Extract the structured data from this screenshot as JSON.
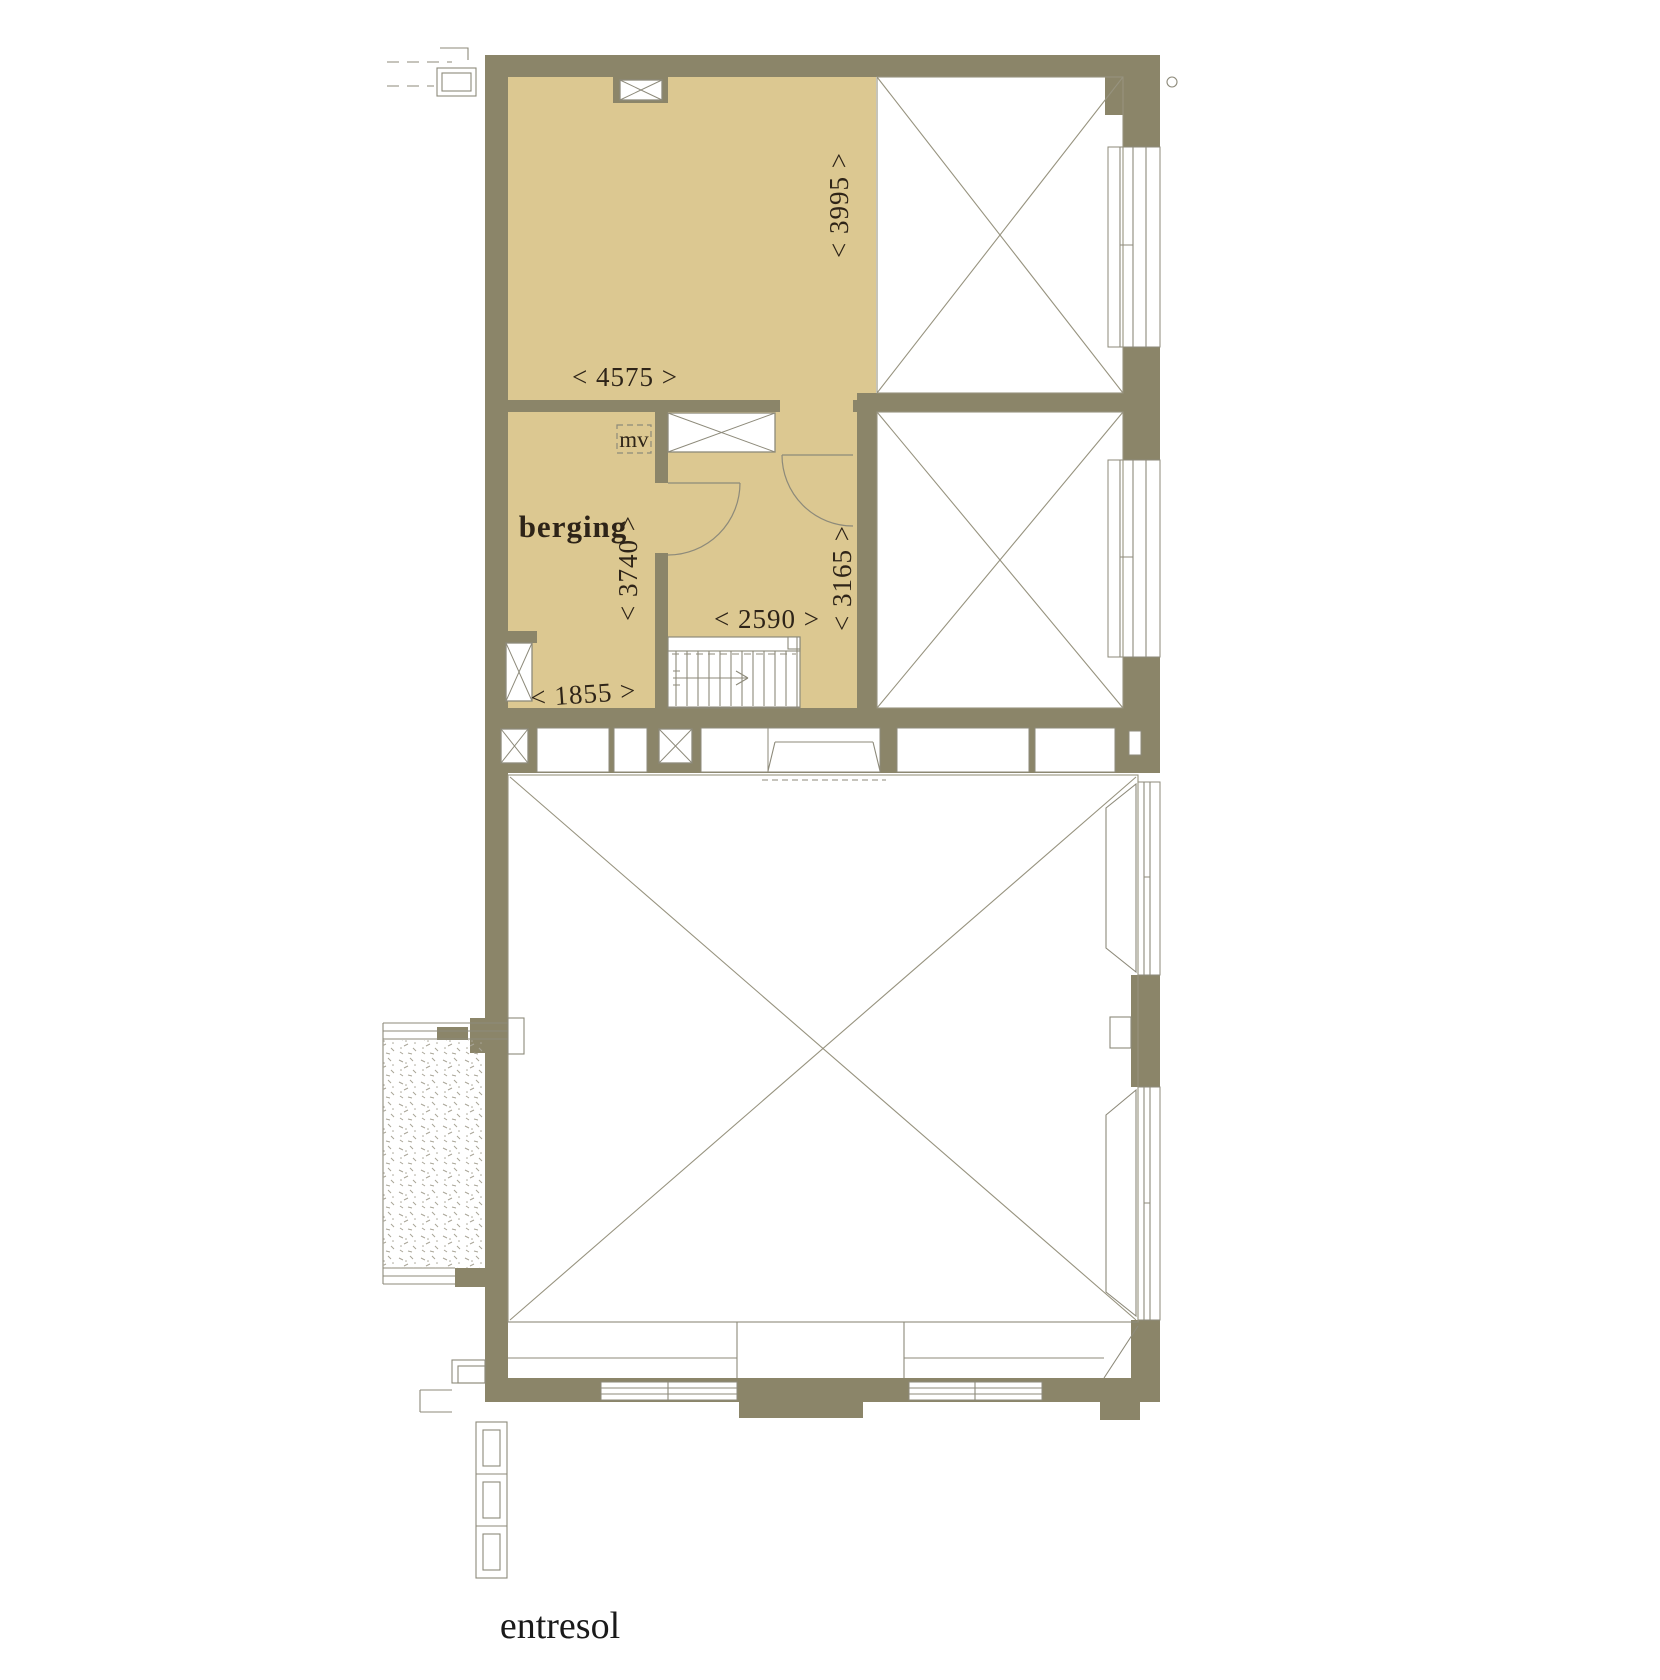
{
  "drawing": {
    "floor_label": "entresol",
    "room_labels": {
      "berging": "berging",
      "mv": "mv"
    },
    "dimensions": {
      "top_room_depth": "< 3995 >",
      "top_room_width": "< 4575 >",
      "berging_depth": "< 3740 >",
      "berging_width": "< 1855 >",
      "stair_hall_width": "< 2590 >",
      "stair_hall_depth": "< 3165 >"
    }
  },
  "colors": {
    "wall": "#8b8569",
    "floor_fill": "#dcc891",
    "line": "#8d8a7a",
    "line_light": "#a9a597",
    "text": "#2e2418",
    "white": "#ffffff"
  }
}
